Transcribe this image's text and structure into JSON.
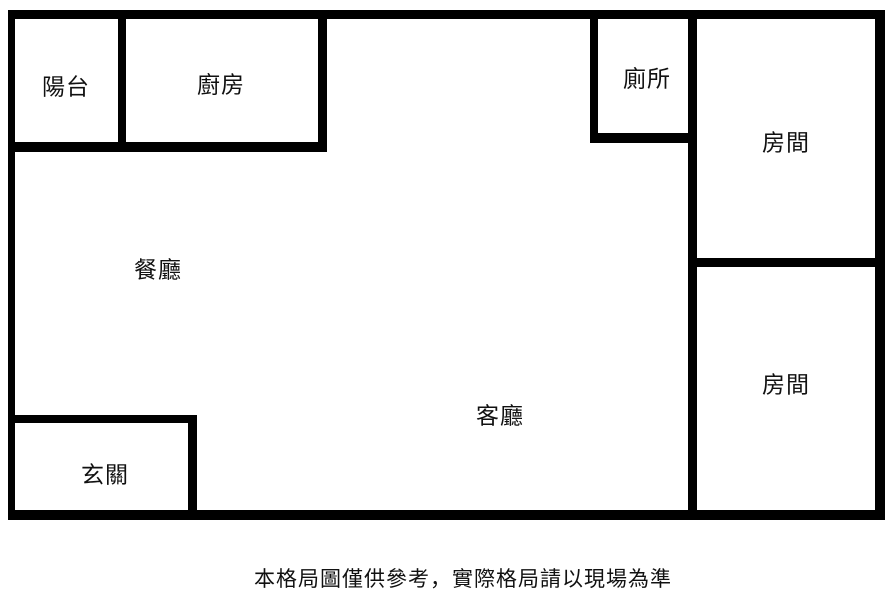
{
  "plan": {
    "title": "apartment-floor-plan",
    "rooms": [
      {
        "id": "balcony",
        "label": "陽台"
      },
      {
        "id": "kitchen",
        "label": "廚房"
      },
      {
        "id": "toilet",
        "label": "廁所"
      },
      {
        "id": "bedroom-top",
        "label": "房間"
      },
      {
        "id": "dining-room",
        "label": "餐廳"
      },
      {
        "id": "living-room",
        "label": "客廳"
      },
      {
        "id": "bedroom-bottom",
        "label": "房間"
      },
      {
        "id": "entrance",
        "label": "玄關"
      }
    ],
    "disclaimer": "本格局圖僅供參考，實際格局請以現場為準",
    "colors": {
      "wall": "#000000",
      "background": "#ffffff",
      "text": "#111111"
    }
  }
}
